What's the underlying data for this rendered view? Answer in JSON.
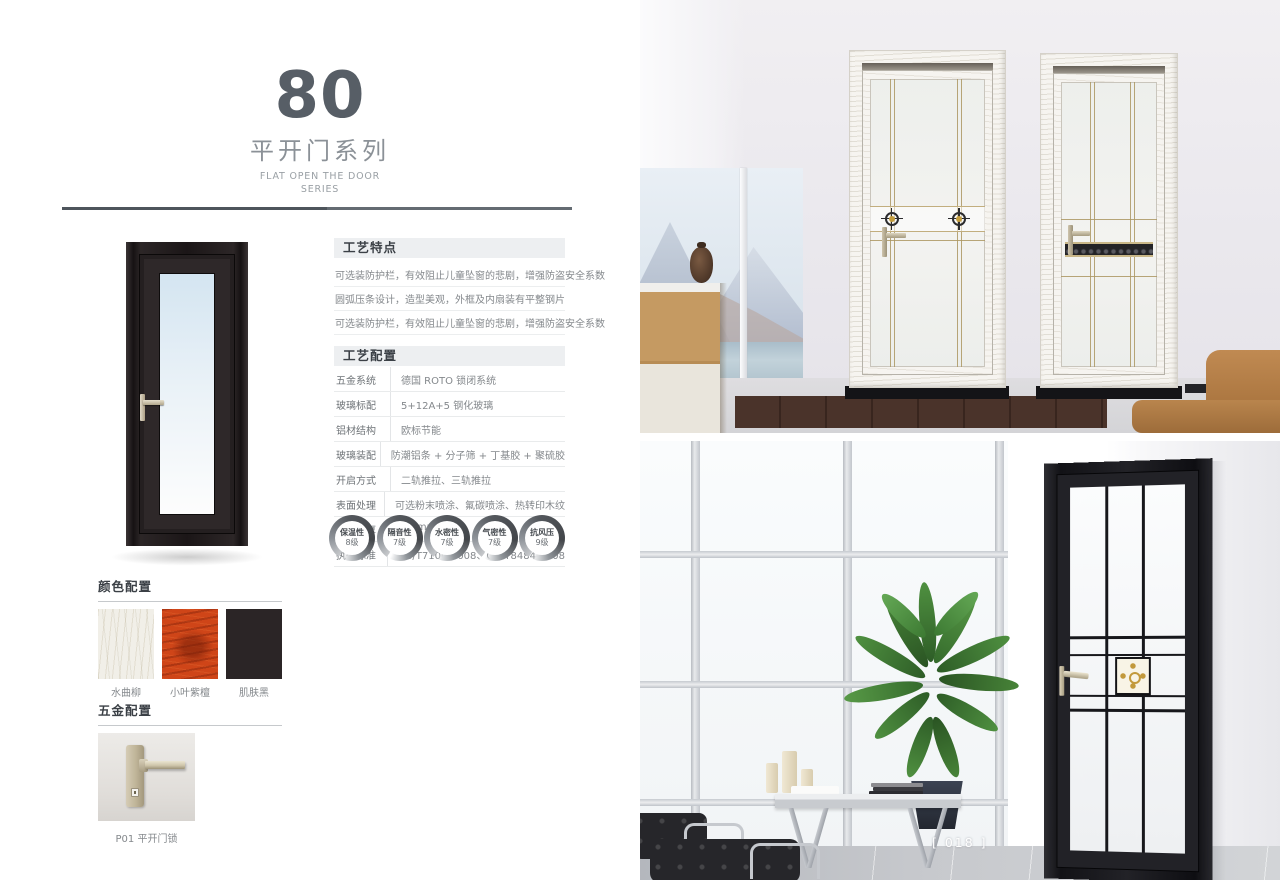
{
  "page": {
    "series_number": "80",
    "series_name_cn": "平开门系列",
    "series_name_en_line1": "FLAT OPEN THE DOOR",
    "series_name_en_line2": "SERIES",
    "page_number": "[ 018 ]"
  },
  "craft_features": {
    "title": "工艺特点",
    "items": [
      "可选装防护栏，有效阻止儿童坠窗的悲剧，增强防盗安全系数",
      "圆弧压条设计，造型美观，外框及内扇装有平整钢片",
      "可选装防护栏，有效阻止儿童坠窗的悲剧，增强防盗安全系数"
    ]
  },
  "craft_config": {
    "title": "工艺配置",
    "rows": [
      {
        "label": "五金系统",
        "value": "德国 ROTO 锁闭系统"
      },
      {
        "label": "玻璃标配",
        "value": "5+12A+5 钢化玻璃"
      },
      {
        "label": "铝材结构",
        "value": "欧标节能"
      },
      {
        "label": "玻璃装配",
        "value": "防潮铝条 + 分子筛 + 丁基胶 + 聚硫胶"
      },
      {
        "label": "开启方式",
        "value": "二轨推拉、三轨推拉"
      },
      {
        "label": "表面处理",
        "value": "可选粉末喷涂、氟碳喷涂、热转印木纹"
      },
      {
        "label": "型材壁厚",
        "value": "1.4mm"
      },
      {
        "label": "执行标准",
        "value": "GB/T7106-2008、GB/T8484-2008"
      }
    ]
  },
  "performance_badges": [
    {
      "name": "保温性",
      "level": "8级"
    },
    {
      "name": "隔音性",
      "level": "7级"
    },
    {
      "name": "水密性",
      "level": "7级"
    },
    {
      "name": "气密性",
      "level": "7级"
    },
    {
      "name": "抗风压",
      "level": "9级"
    }
  ],
  "color_config": {
    "title": "颜色配置",
    "swatches": [
      {
        "name": "水曲柳",
        "color": "#f1efe8"
      },
      {
        "name": "小叶紫檀",
        "color": "#cf4518"
      },
      {
        "name": "肌肤黑",
        "color": "#2b2526"
      }
    ]
  },
  "hardware_config": {
    "title": "五金配置",
    "item_label": "P01 平开门锁"
  },
  "colors": {
    "title_gray": "#575e66",
    "heading_bg": "#edeff1",
    "heading_text": "#3b4046",
    "body_text": "#84888c",
    "divider": "#4e555c",
    "door_black": "#1d1819",
    "handle_champagne": "#c9bfa6",
    "page_number_text": "#ffffff"
  }
}
